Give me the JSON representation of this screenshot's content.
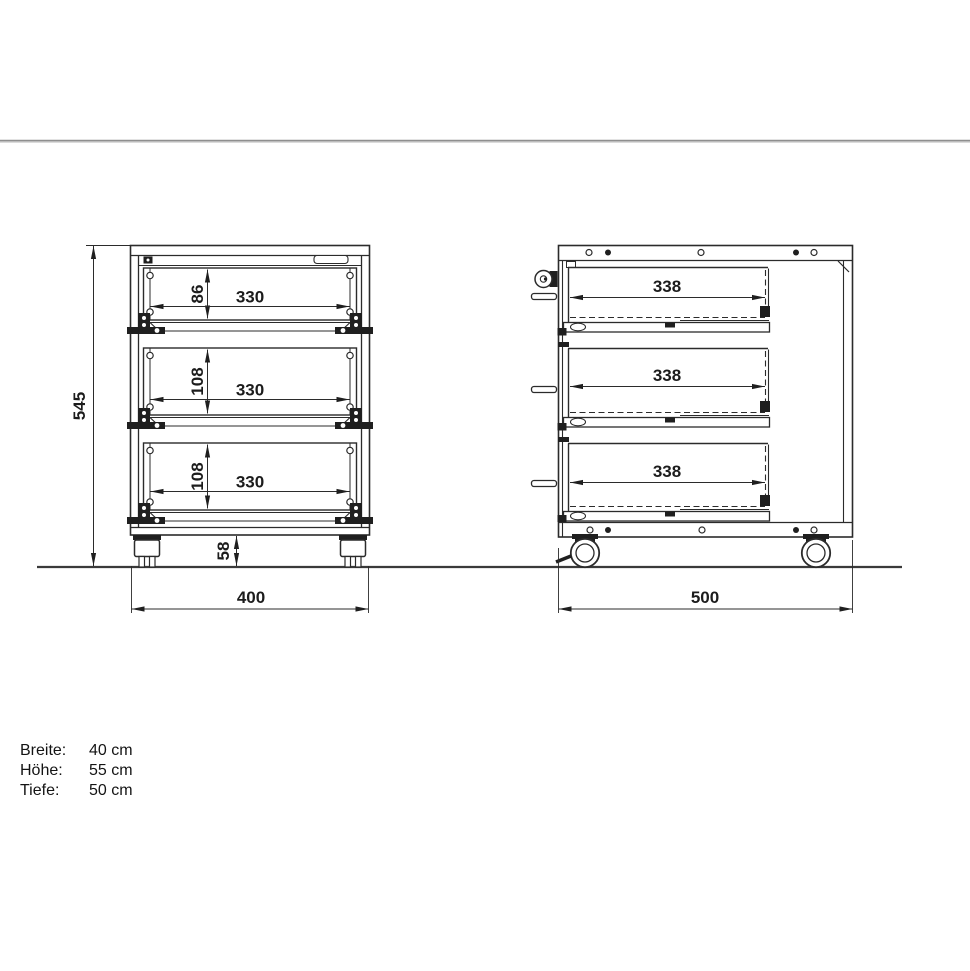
{
  "front_view": {
    "overall_height": "545",
    "overall_width": "400",
    "caster_height": "58",
    "drawers": [
      {
        "inner_height": "86",
        "inner_width": "330"
      },
      {
        "inner_height": "108",
        "inner_width": "330"
      },
      {
        "inner_height": "108",
        "inner_width": "330"
      }
    ]
  },
  "side_view": {
    "overall_depth": "500",
    "drawers": [
      {
        "inner_depth": "338"
      },
      {
        "inner_depth": "338"
      },
      {
        "inner_depth": "338"
      }
    ]
  },
  "specs": [
    {
      "label": "Breite:",
      "value": "40 cm"
    },
    {
      "label": "Höhe:",
      "value": "55 cm"
    },
    {
      "label": "Tiefe:",
      "value": "50 cm"
    }
  ]
}
